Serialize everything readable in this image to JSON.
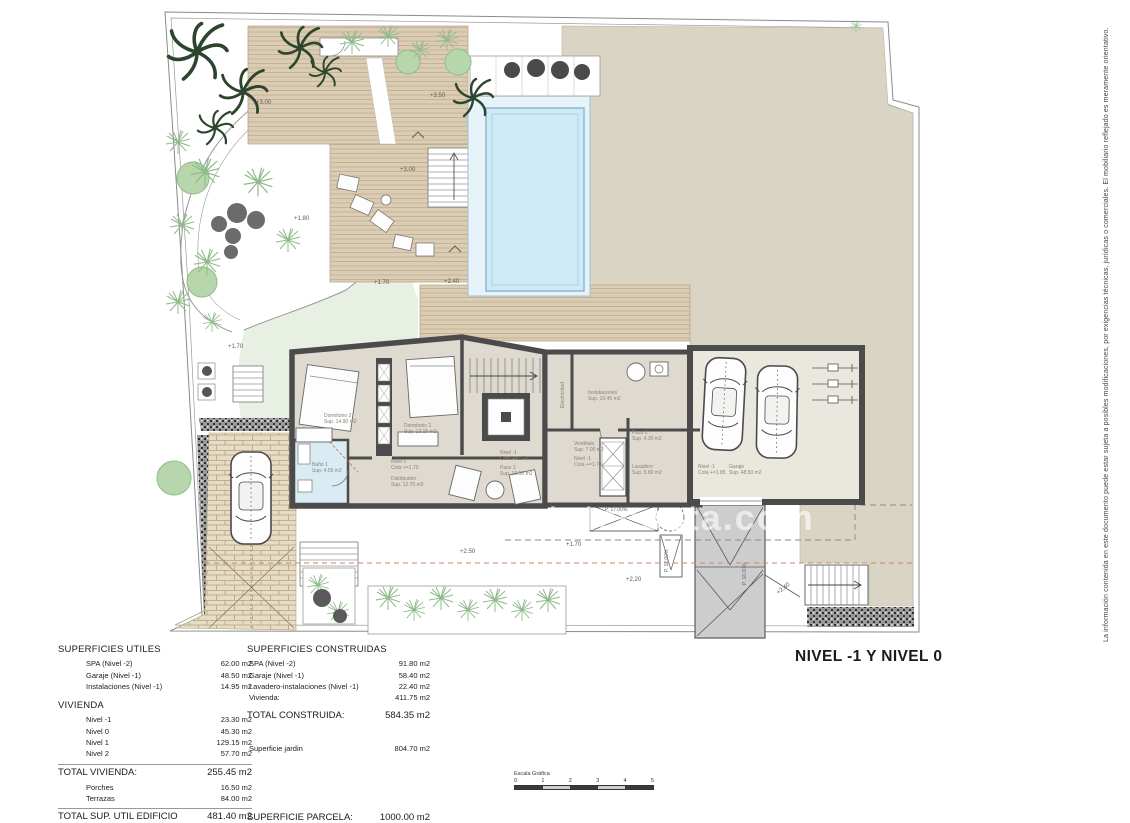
{
  "document": {
    "title": "NIVEL -1 Y NIVEL 0",
    "watermark": "www.estatecosta.com",
    "disclaimer": "La información contenida en este documento puede estar sujeta a posibles modificaciones, por exigencias técnicas, jurídicas o comerciales. El mobiliario reflejado es meramente orientativo."
  },
  "plan": {
    "room_labels": [
      {
        "name": "Dormitorio 2",
        "detail": "Sup. 14.90 m2"
      },
      {
        "name": "Dormitorio 1",
        "detail": "Sup. 13.15 m2"
      },
      {
        "name": "Baño 1",
        "detail": "Sup. 4.55 m2"
      },
      {
        "name": "Nivel 0",
        "detail": "Cota +=1.70"
      },
      {
        "name": "Distribuidor",
        "detail": "Sup. 12.70 m2"
      },
      {
        "name": "Electricidad",
        "detail": ""
      },
      {
        "name": "Instalaciones",
        "detail": "Sup. 10.45 m2"
      },
      {
        "name": "Vestibulo",
        "detail": "Sup. 7.00 m2"
      },
      {
        "name": "Nivel -1",
        "detail": "Cota +=1.70"
      },
      {
        "name": "Paso 2",
        "detail": "Sup. 4.30 m2"
      },
      {
        "name": "Lavadero",
        "detail": "Sup. 5.80 m2"
      },
      {
        "name": "Nivel -1",
        "detail": "Cota +=1.70"
      },
      {
        "name": "Paso 1",
        "detail": "Sup. 10.50 m2"
      },
      {
        "name": "Nivel -1",
        "detail": "Cota +=1.85"
      },
      {
        "name": "Garaje",
        "detail": "Sup. 48.50 m2"
      }
    ],
    "elevation_labels": [
      "+3.00",
      "+3.50",
      "+3.00",
      "+1.80",
      "+1.70",
      "+1.70",
      "+2.40",
      "+2.50",
      "+1.70",
      "+2.20",
      "+2.40"
    ],
    "slope_labels": [
      "P. 17.00%",
      "P. 12.00%",
      "P. 16.00%"
    ]
  },
  "tables": {
    "left": {
      "title": "SUPERFICIES UTILES",
      "rows": [
        {
          "label": "SPA (Nivel -2)",
          "value": "62.00 m2"
        },
        {
          "label": "Garaje (Nivel -1)",
          "value": "48.50 m2"
        },
        {
          "label": "Instalaciones (Nivel -1)",
          "value": "14.95 m2"
        }
      ],
      "section2": "VIVIENDA",
      "rows2": [
        {
          "label": "Nivel -1",
          "value": "23.30 m2"
        },
        {
          "label": "Nivel 0",
          "value": "45.30 m2"
        },
        {
          "label": "Nivel 1",
          "value": "129.15 m2"
        },
        {
          "label": "Nivel 2",
          "value": "57.70 m2"
        }
      ],
      "total1": {
        "label": "TOTAL VIVIENDA:",
        "value": "255.45 m2"
      },
      "rows3": [
        {
          "label": "Porches",
          "value": "16.50 m2"
        },
        {
          "label": "Terrazas",
          "value": "84.00 m2"
        }
      ],
      "total2": {
        "label": "TOTAL SUP. UTIL EDIFICIO",
        "value": "481.40 m2"
      }
    },
    "middle": {
      "title": "SUPERFICIES CONSTRUIDAS",
      "rows": [
        {
          "label": "SPA (Nivel -2)",
          "value": "91.80 m2"
        },
        {
          "label": "Garaje (Nivel -1)",
          "value": "58.40 m2"
        },
        {
          "label": "Lavadero-instalaciones (Nivel -1)",
          "value": "22.40 m2"
        },
        {
          "label": "Vivienda:",
          "value": "411.75 m2"
        }
      ],
      "total": {
        "label": "TOTAL CONSTRUIDA:",
        "value": "584.35 m2"
      },
      "garden": {
        "label": "Superficie jardin",
        "value": "804.70 m2"
      },
      "parcel": {
        "label": "SUPERFICIE PARCELA:",
        "value": "1000.00 m2"
      }
    }
  },
  "scale_bar": {
    "label": "Escala Gráfica",
    "ticks": [
      "0",
      "1",
      "2",
      "3",
      "4",
      "5"
    ]
  },
  "colors": {
    "terrain": "#d9d4c3",
    "deck": "#dbccb4",
    "pool": "#cdeaf6",
    "lawn": "#e8efe3",
    "wall": "#4b4b4b",
    "floor": "#dfdad0",
    "bath_floor": "#d9ecf4",
    "ramp": "#cdcdcd"
  }
}
